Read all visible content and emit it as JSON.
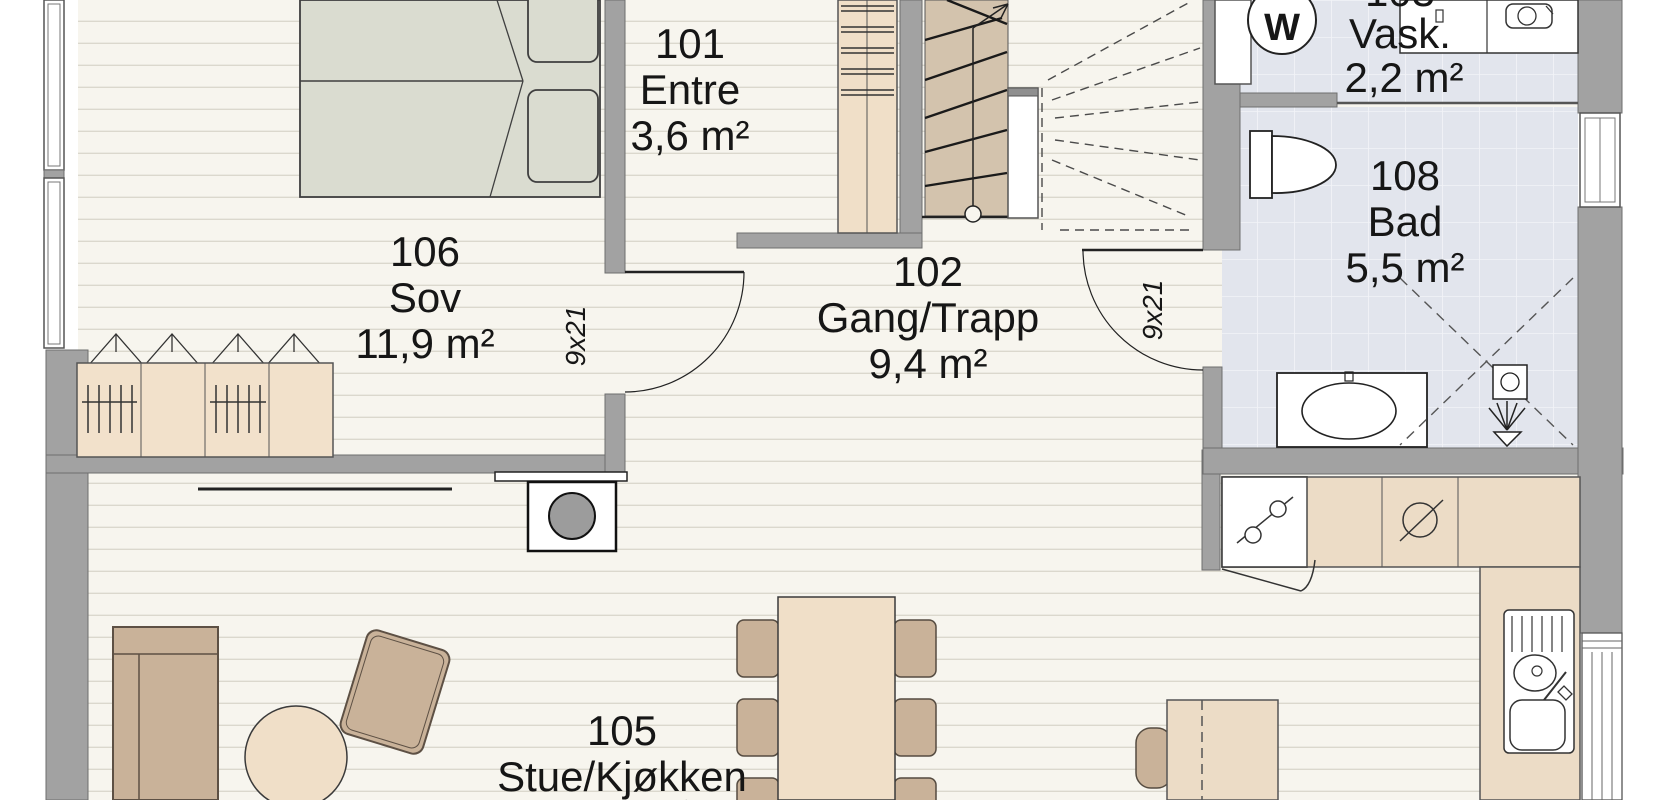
{
  "rooms": [
    {
      "number": "106",
      "name": "Sov",
      "area": "11,9 m²"
    },
    {
      "number": "101",
      "name": "Entre",
      "area": "3,6 m²"
    },
    {
      "number": "102",
      "name": "Gang/Trapp",
      "area": "9,4 m²"
    },
    {
      "number": "103",
      "name": "Vask.",
      "area": "2,2 m²"
    },
    {
      "number": "108",
      "name": "Bad",
      "area": "5,5 m²"
    },
    {
      "number": "105",
      "name": "Stue/Kjøkken",
      "area": "34,6 m²"
    }
  ],
  "doors": {
    "sov_size": "9x21",
    "bad_size": "9x21"
  },
  "appliances": {
    "washing_machine": "W"
  },
  "colors": {
    "wall": "#a2a2a2",
    "wood_floor": "#f7f5ee",
    "tile_floor": "#e2e5ed",
    "cabinet": "#f0dfc8",
    "counter": "#ecdcc6",
    "upholstery": "#c9b299",
    "stairs": "#d3c3ad",
    "bed": "#dadcd0"
  }
}
